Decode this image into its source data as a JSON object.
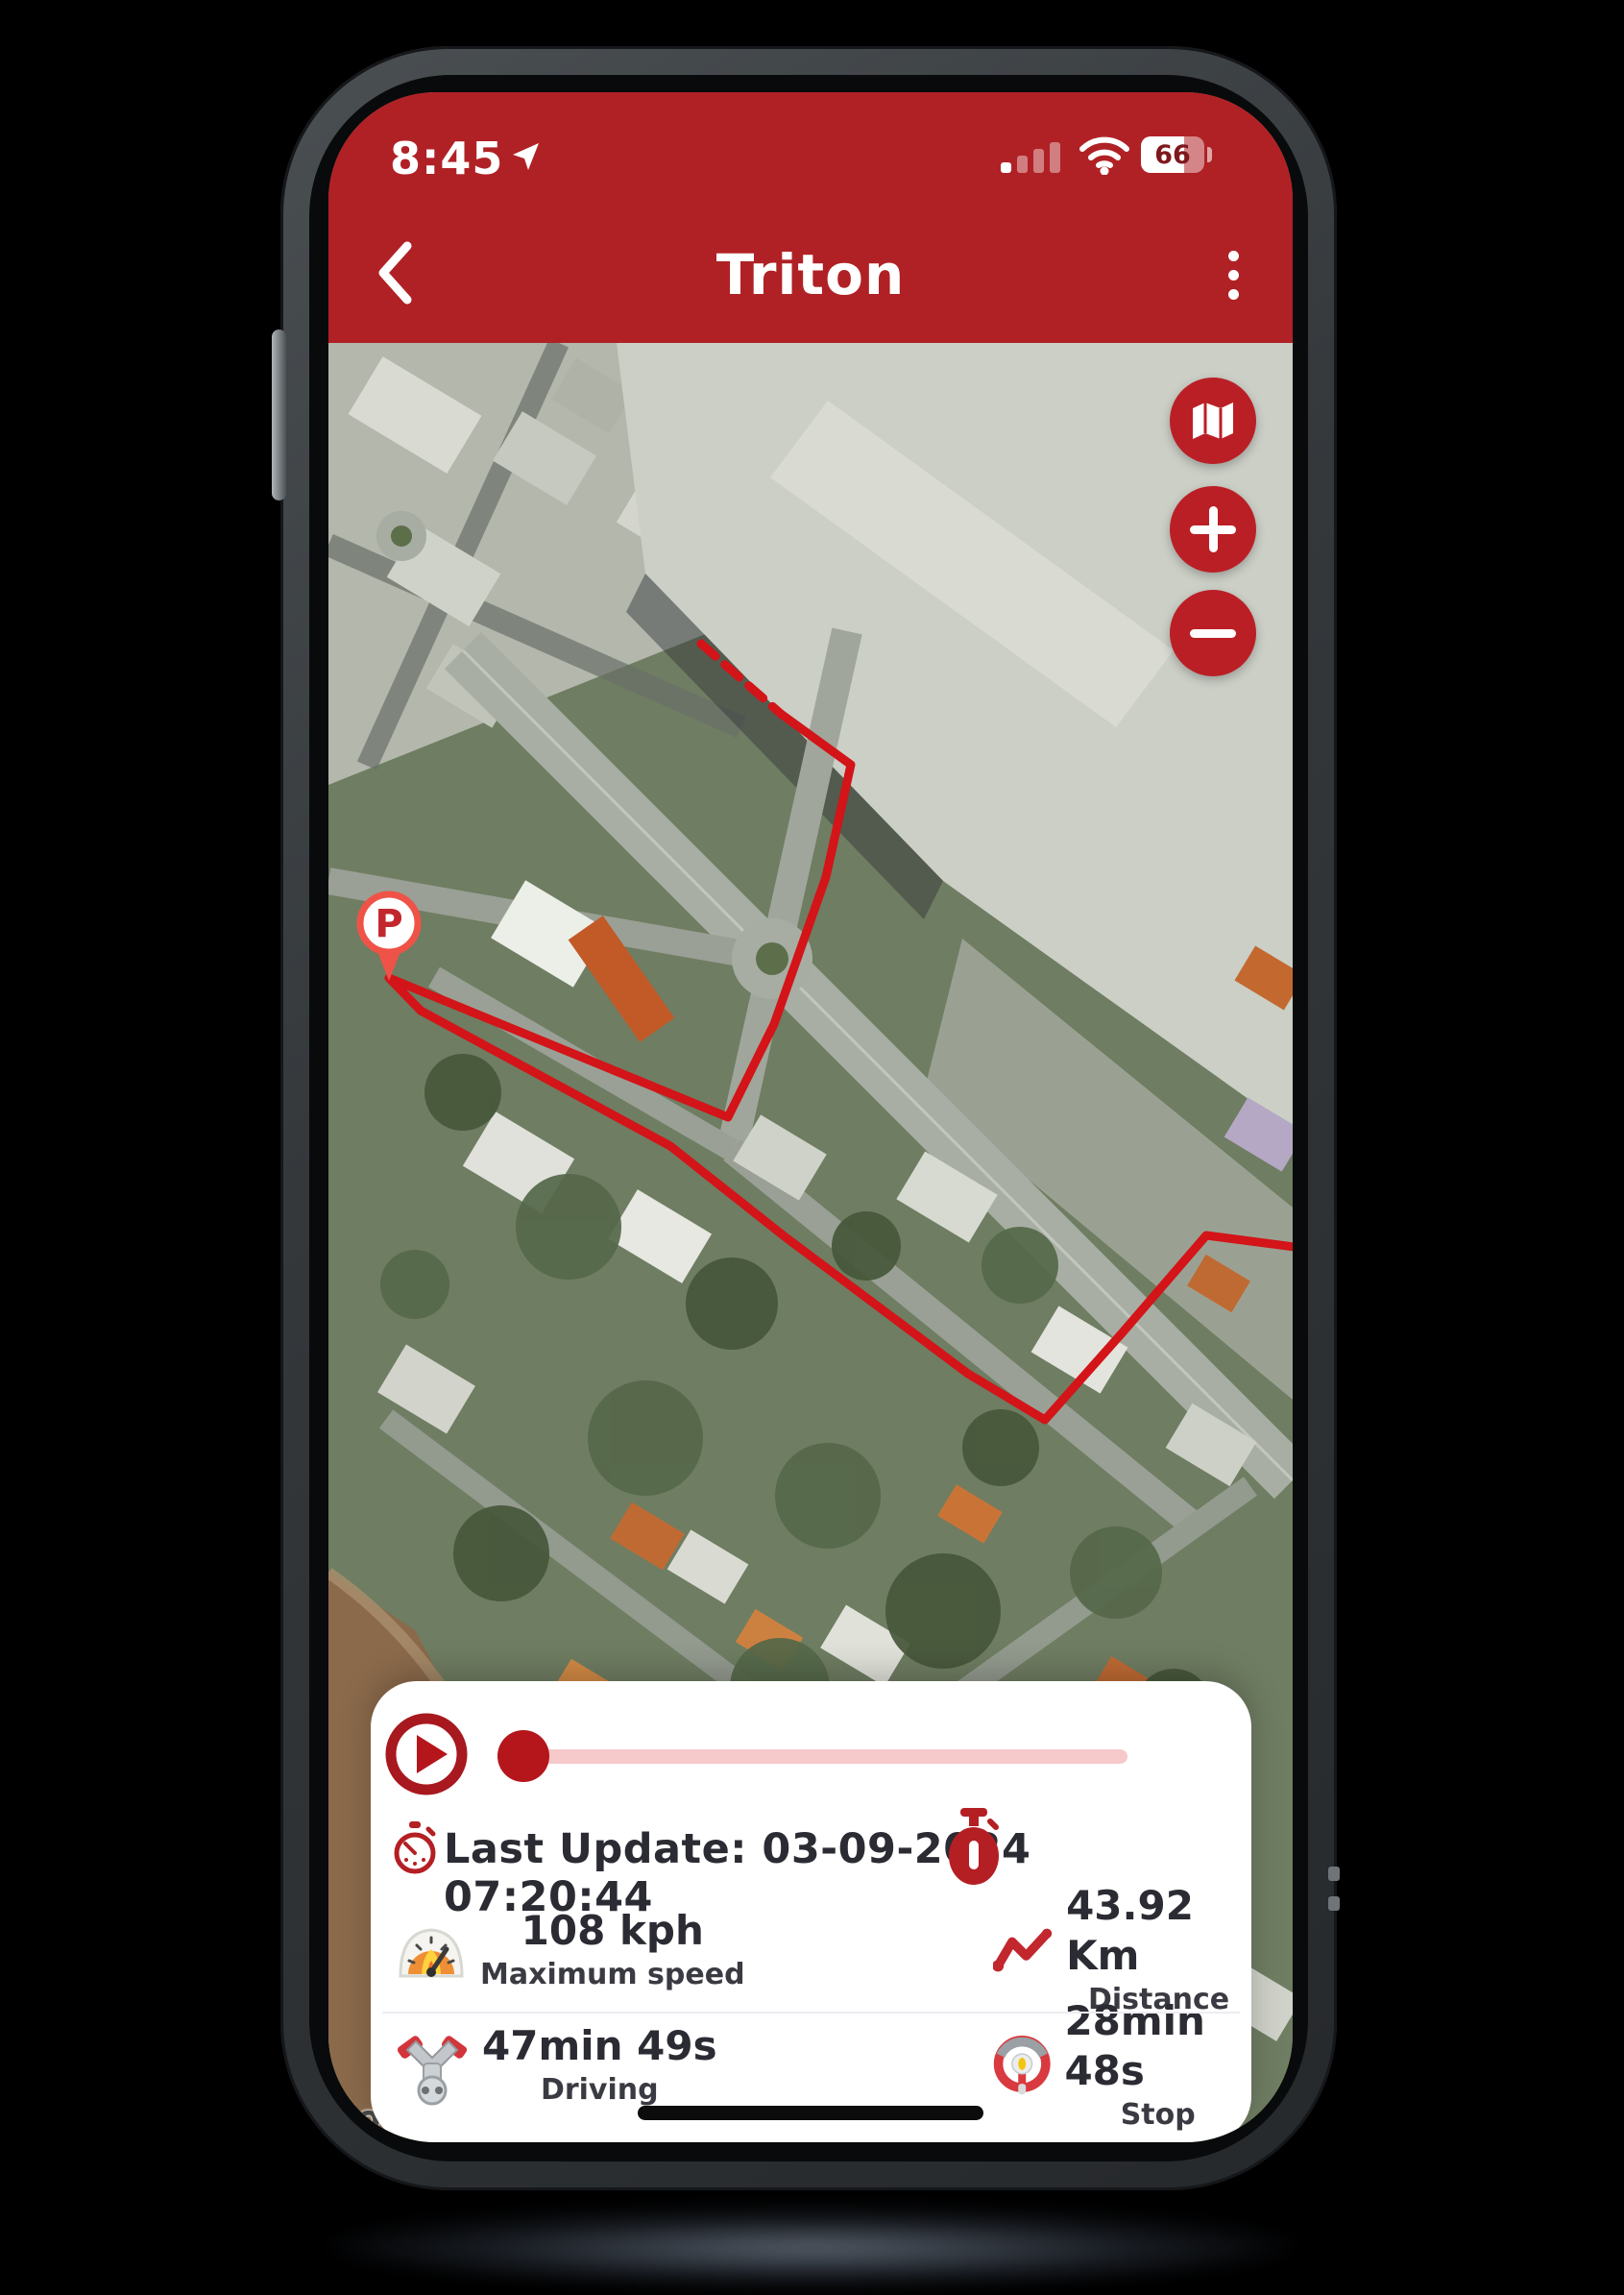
{
  "status_bar": {
    "time": "8:45",
    "battery_percent": "66"
  },
  "header": {
    "title": "Triton"
  },
  "map": {
    "parking_marker_label": "P",
    "watermark": "Google",
    "route_color": "#d31418",
    "route_dashed_points": "388,313 471,386",
    "route_points": "471,386 544,439 518,556 464,709 416,806 63,661 96,695 356,836 476,931 666,1073 746,1121 826,1031 914,929 1006,941"
  },
  "controls": {
    "map_type_icon": "map-icon",
    "zoom_in_label": "+",
    "zoom_out_label": "−"
  },
  "panel": {
    "last_update": "Last Update: 03-09-2024 07:20:44",
    "stats": [
      {
        "value": "108 kph",
        "label": "Maximum speed",
        "icon": "speedometer-icon"
      },
      {
        "value": "43.92 Km",
        "label": "Distance",
        "icon": "route-distance-icon"
      },
      {
        "value": "47min 49s",
        "label": "Driving",
        "icon": "engine-icon"
      },
      {
        "value": "28min 48s",
        "label": "Stop",
        "icon": "steering-wheel-icon"
      }
    ]
  },
  "colors": {
    "brand_red": "#b02125",
    "button_red": "#bb1f26",
    "route_red": "#d31418",
    "slider_track_pink": "#f6c9ca",
    "slider_thumb_red": "#b5161c",
    "text_dark": "#2b2b33",
    "river_brown": "#8b6a4b"
  }
}
